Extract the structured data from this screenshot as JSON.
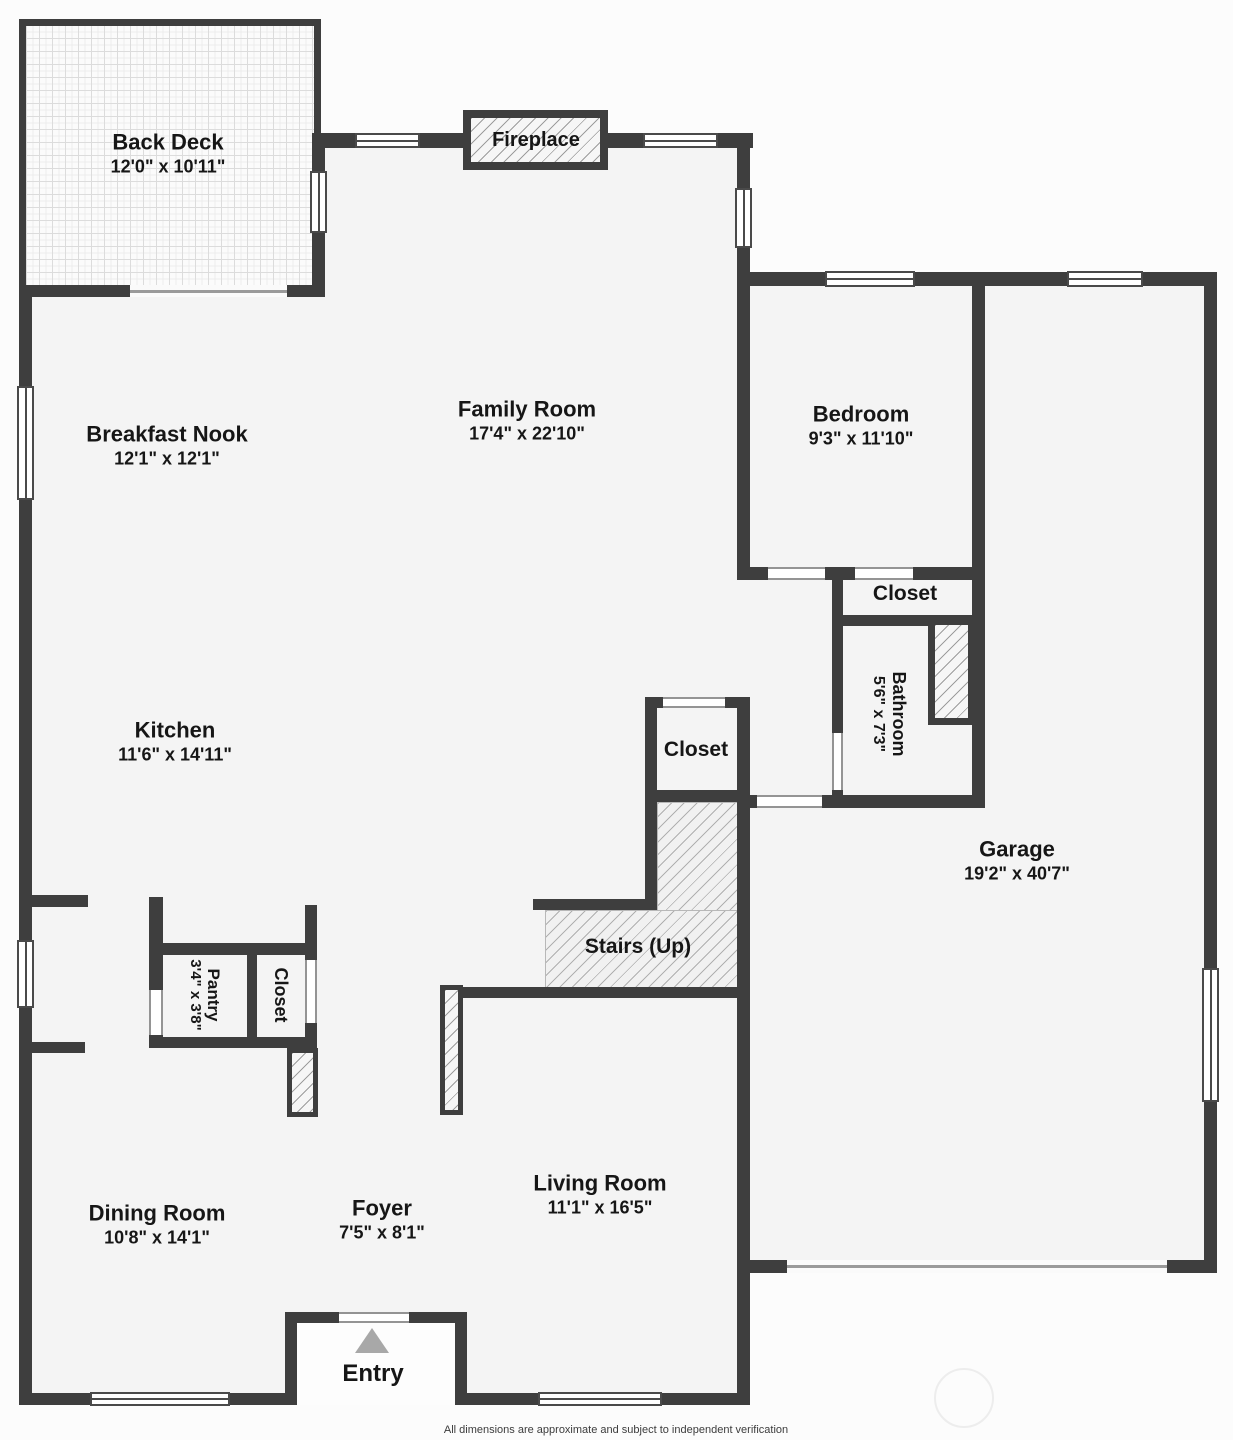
{
  "plan": {
    "footer": "All dimensions are approximate and subject to independent verification",
    "colors": {
      "wall": "#3e3e3e",
      "floor": "#f4f4f4",
      "hatch_line": "#a8a8a8",
      "arrow": "#a8a8a8"
    },
    "rooms": {
      "back_deck": {
        "name": "Back Deck",
        "dims": "12'0\" x 10'11\""
      },
      "family_room": {
        "name": "Family Room",
        "dims": "17'4\" x 22'10\""
      },
      "breakfast_nook": {
        "name": "Breakfast Nook",
        "dims": "12'1\" x 12'1\""
      },
      "bedroom": {
        "name": "Bedroom",
        "dims": "9'3\" x 11'10\""
      },
      "kitchen": {
        "name": "Kitchen",
        "dims": "11'6\" x 14'11\""
      },
      "bathroom": {
        "name": "Bathroom",
        "dims": "5'6\" x 7'3\""
      },
      "garage": {
        "name": "Garage",
        "dims": "19'2\" x 40'7\""
      },
      "pantry": {
        "name": "Pantry",
        "dims": "3'4\" x 3'8\""
      },
      "dining_room": {
        "name": "Dining Room",
        "dims": "10'8\" x 14'1\""
      },
      "foyer": {
        "name": "Foyer",
        "dims": "7'5\" x 8'1\""
      },
      "living_room": {
        "name": "Living Room",
        "dims": "11'1\" x 16'5\""
      }
    },
    "features": {
      "fireplace": "Fireplace",
      "bedroom_closet": "Closet",
      "hall_closet": "Closet",
      "kitchen_closet": "Closet",
      "stairs": "Stairs (Up)",
      "entry": "Entry"
    }
  }
}
